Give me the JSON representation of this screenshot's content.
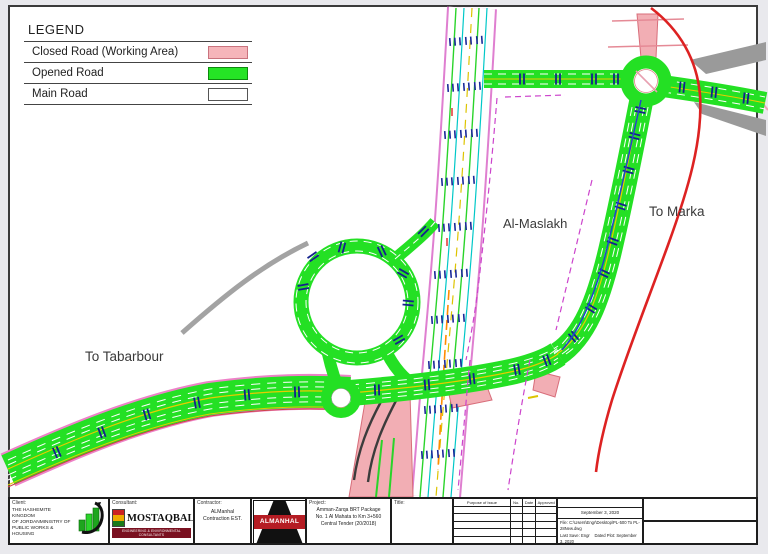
{
  "legend": {
    "title": "LEGEND",
    "items": [
      {
        "label": "Closed Road (Working Area)",
        "color": "#f5b5ba"
      },
      {
        "label": "Opened Road",
        "color": "#25e425"
      },
      {
        "label": "Main Road",
        "color": "#ffffff"
      }
    ]
  },
  "map": {
    "labels": {
      "al_maslakh": "Al-Maslakh",
      "to_marka": "To Marka",
      "to_tabarbour": "To Tabarbour"
    },
    "colors": {
      "opened_road": "#25e425",
      "closed_road": "#f2aeb4",
      "main_road": "#ffffff",
      "detour_red_line": "#dd2222",
      "boundary_magenta": "#cc44cc",
      "lane_tick_navy": "#1b2a99"
    }
  },
  "title_block": {
    "client": {
      "label": "Client:",
      "lines": {
        "0": "THE HASHEMITE KINGDOM",
        "1": "OF JORDANMINISTRY OF",
        "2": "PUBLIC WORKS & HOUSING"
      }
    },
    "consultant": {
      "label": "Consultant:",
      "name": "MOSTAQBAL",
      "tagline": "ENGINEERING & ENVIRONMENTAL CONSULTANTS"
    },
    "contractor": {
      "label": "Contractor:",
      "name": "ALManhal Contraction EST."
    },
    "contractor_logo_text": "ALMANHAL",
    "project": {
      "label": "Project:",
      "lines": {
        "0": "Amman-Zarqa BRT Package",
        "1": "No. 1 Al Mahata to Km 3+560",
        "2": "Central Tender (20/2018)"
      }
    },
    "title_label": "Title:",
    "issue_table": {
      "headers": {
        "purpose": "Purpose of Issue",
        "no": "No.",
        "date": "Date",
        "approved": "Approved"
      }
    },
    "plot_info": {
      "date": "September 3, 2020",
      "file": "File: C:\\Users\\Engr\\Desktop\\PL-500 To PL-28New.dwg",
      "last_save": "Last Save: Engr",
      "dated_plot": "Dated Plot: September 3, 2020"
    }
  }
}
